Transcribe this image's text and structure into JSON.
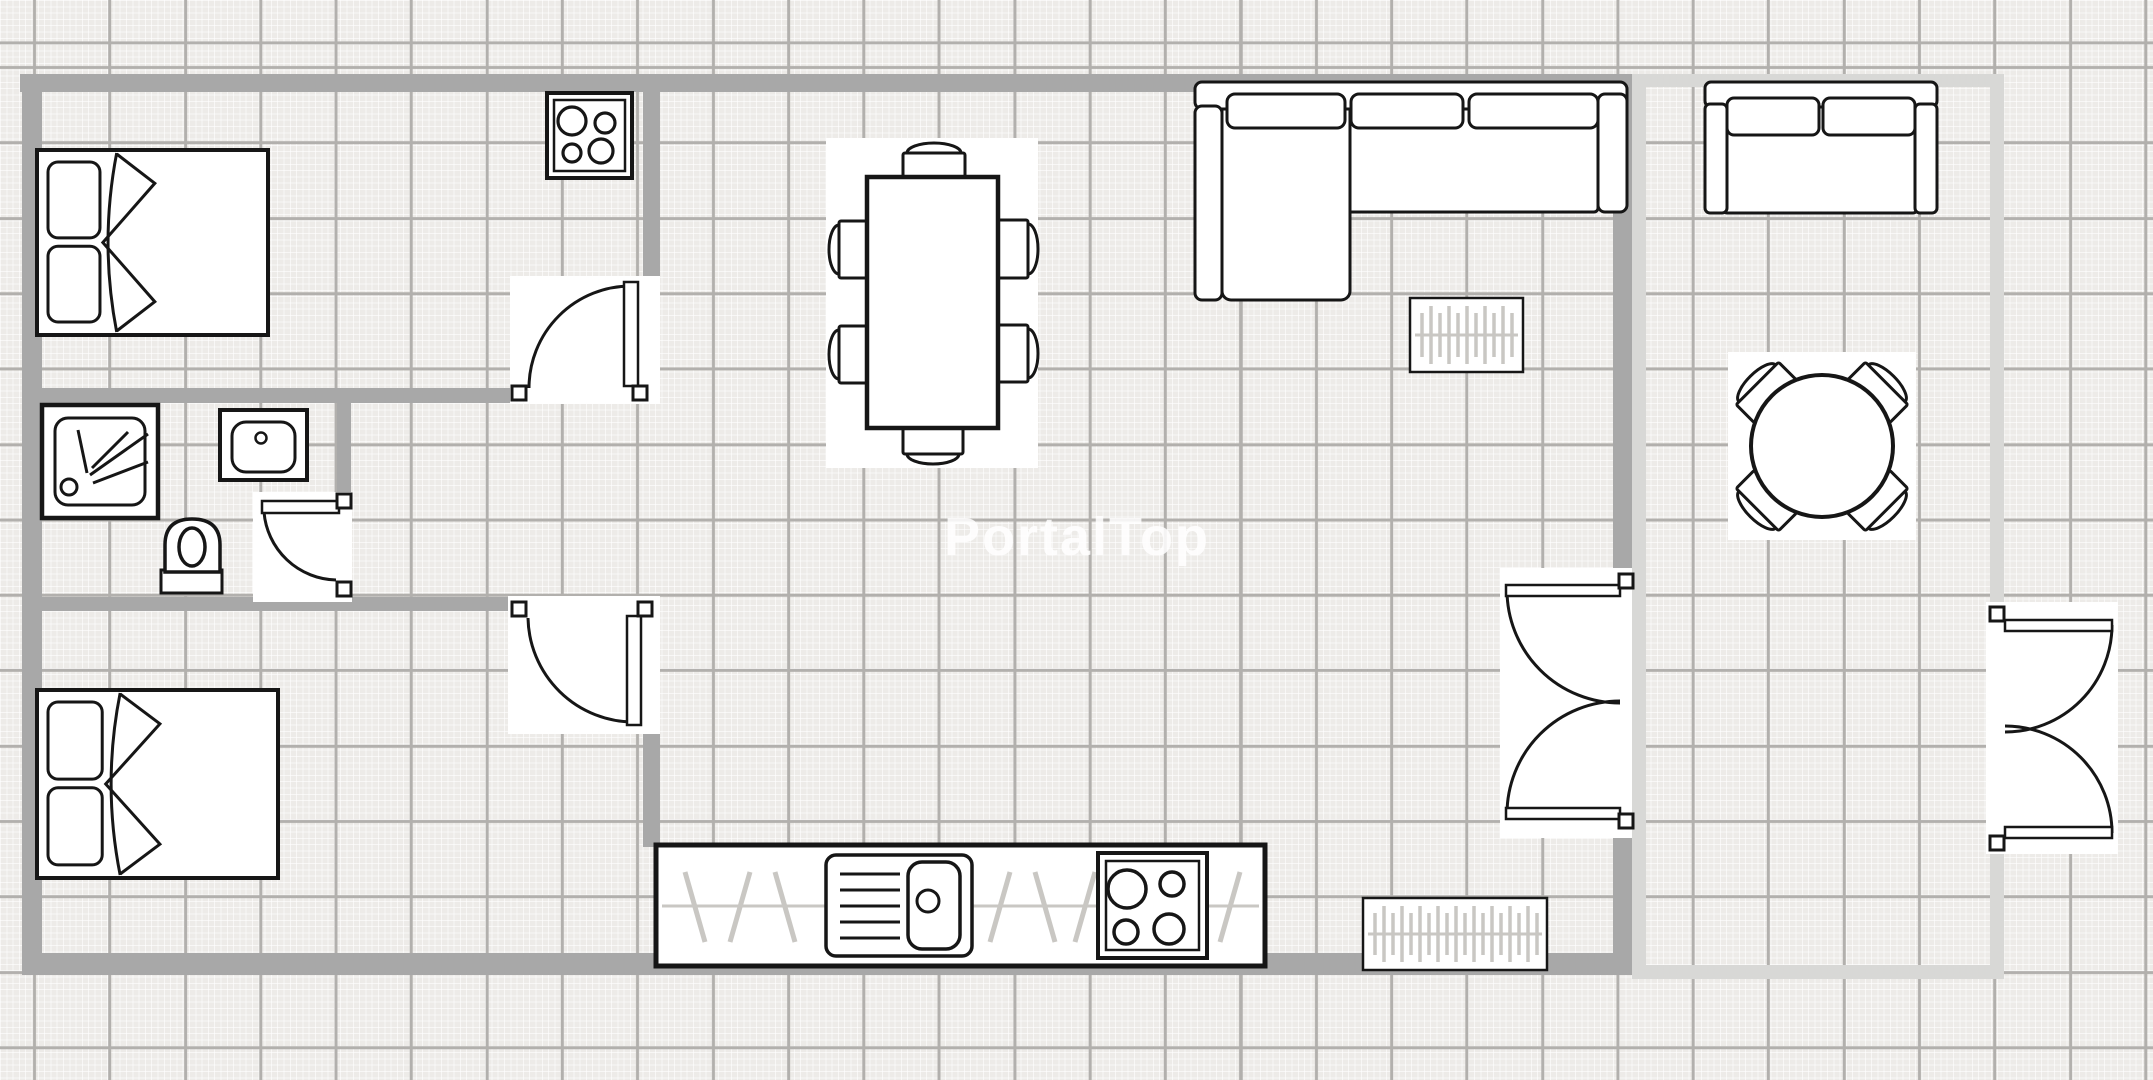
{
  "app": {
    "name": "floor-plan",
    "watermark_text": "PortalTop"
  },
  "canvas": {
    "w": 2153,
    "h": 1080,
    "bg": "#edebe8",
    "fine_line": "rgba(255,255,255,0.62)",
    "fine_step": 6.3,
    "major_line": "#b2b0ad",
    "major_step": 75.4,
    "major_off_x": 33,
    "major_off_y": 66,
    "wall_color": "#a8a8a8",
    "wall_light_color": "#d8d8d6",
    "ink": "#161616",
    "pattern_color": "#c9c7c3",
    "backdrop": "#ffffff"
  },
  "watermark": {
    "text": "PortalTop",
    "x": 1077,
    "y": 555,
    "font_size": 54,
    "color": "rgba(255,255,255,0.85)"
  },
  "walls": [
    {
      "name": "wall-outer-top",
      "rect": [
        20,
        74,
        1612,
        18
      ]
    },
    {
      "name": "wall-outer-left",
      "rect": [
        22,
        74,
        20,
        901
      ]
    },
    {
      "name": "wall-outer-bottom",
      "rect": [
        22,
        953,
        1610,
        22
      ]
    },
    {
      "name": "wall-bedroom1-south",
      "rect": [
        42,
        388,
        473,
        15
      ]
    },
    {
      "name": "wall-bedroom1-east",
      "rect": [
        643,
        74,
        17,
        330
      ]
    },
    {
      "name": "wall-bathroom-east",
      "rect": [
        337,
        395,
        14,
        103
      ]
    },
    {
      "name": "wall-bedroom2-north",
      "rect": [
        42,
        597,
        470,
        14
      ]
    },
    {
      "name": "wall-bedroom2-east",
      "rect": [
        643,
        611,
        17,
        236
      ]
    },
    {
      "name": "wall-living-divider-upper",
      "rect": [
        1613,
        74,
        19,
        502
      ]
    },
    {
      "name": "wall-living-divider-lower",
      "rect": [
        1613,
        830,
        19,
        145
      ]
    },
    {
      "name": "wall-terrace-top",
      "rect": [
        1632,
        74,
        372,
        13
      ],
      "light": true
    },
    {
      "name": "wall-terrace-west",
      "rect": [
        1632,
        87,
        14,
        878
      ],
      "light": true
    },
    {
      "name": "wall-terrace-east-upper",
      "rect": [
        1990,
        87,
        14,
        521
      ],
      "light": true
    },
    {
      "name": "wall-terrace-east-lower",
      "rect": [
        1990,
        852,
        14,
        113
      ],
      "light": true
    },
    {
      "name": "wall-terrace-bottom",
      "rect": [
        1632,
        965,
        372,
        14
      ],
      "light": true
    }
  ],
  "doors": [
    {
      "name": "door-bedroom1",
      "backdrop": [
        510,
        276,
        150,
        128
      ],
      "stops": [
        [
          512,
          386
        ],
        [
          633,
          386
        ]
      ],
      "leaf": [
        624,
        282,
        14,
        104
      ],
      "arc": "M 631 286 A 102 102 0 0 0 529 388"
    },
    {
      "name": "door-bathroom",
      "backdrop": [
        253,
        492,
        99,
        110
      ],
      "stops": [
        [
          337,
          494
        ],
        [
          337,
          582
        ]
      ],
      "leaf": [
        262,
        501,
        77,
        12
      ],
      "arc": "M 264 512 A 74 74 0 0 0 336 580"
    },
    {
      "name": "door-bedroom2",
      "backdrop": [
        508,
        596,
        152,
        138
      ],
      "stops": [
        [
          512,
          602
        ],
        [
          638,
          602
        ]
      ],
      "leaf": [
        627,
        616,
        14,
        109
      ],
      "arc": "M 528 618 A 106 106 0 0 0 634 722"
    },
    {
      "name": "door-living-terrace",
      "backdrop": [
        1500,
        568,
        132,
        270
      ],
      "stops": [
        [
          1619,
          574
        ],
        [
          1619,
          814
        ]
      ],
      "leaf": [
        1506,
        585,
        114,
        11
      ],
      "leaf2": [
        1506,
        808,
        114,
        11
      ],
      "arc": "M 1507 590 A 113 113 0 0 0 1620 703",
      "arc2": "M 1507 814 A 113 113 0 0 1 1620 701"
    },
    {
      "name": "door-terrace-exterior",
      "backdrop": [
        1986,
        602,
        132,
        252
      ],
      "stops": [
        [
          1990,
          607
        ],
        [
          1990,
          836
        ]
      ],
      "leaf": [
        2005,
        620,
        107,
        11
      ],
      "leaf2": [
        2005,
        827,
        107,
        11
      ],
      "arc": "M 2112 625 A 107 107 0 0 1 2005 732",
      "arc2": "M 2112 833 A 107 107 0 0 0 2005 726"
    }
  ],
  "furniture": [
    {
      "type": "bed",
      "name": "bed-double-bedroom1",
      "rect": [
        37,
        150,
        231,
        185
      ]
    },
    {
      "type": "stove",
      "name": "stove-hob-top",
      "rect": [
        547,
        93,
        85,
        85
      ]
    },
    {
      "type": "shower",
      "name": "shower-tray",
      "rect": [
        42,
        405,
        116,
        113
      ]
    },
    {
      "type": "sink",
      "name": "bathroom-sink",
      "rect": [
        220,
        410,
        87,
        70
      ]
    },
    {
      "type": "toilet",
      "name": "toilet",
      "rect": [
        160,
        517,
        63,
        77
      ]
    },
    {
      "type": "bed",
      "name": "bed-double-bedroom2",
      "rect": [
        37,
        690,
        241,
        188
      ]
    },
    {
      "type": "sofa-sectional",
      "name": "corner-sofa",
      "rect": [
        1195,
        82,
        432,
        218
      ]
    },
    {
      "type": "radiator",
      "name": "radiator-living",
      "rect": [
        1410,
        298,
        113,
        74
      ]
    },
    {
      "type": "dining-set",
      "name": "dining-table-six-chairs",
      "rect": [
        826,
        138,
        212,
        330
      ]
    },
    {
      "type": "counter",
      "name": "kitchen-counter",
      "rect": [
        656,
        845,
        609,
        121
      ]
    },
    {
      "type": "radiator",
      "name": "radiator-kitchen",
      "rect": [
        1363,
        898,
        184,
        72
      ]
    },
    {
      "type": "loveseat",
      "name": "terrace-loveseat",
      "rect": [
        1705,
        82,
        232,
        131
      ]
    },
    {
      "type": "round-table-set",
      "name": "terrace-round-table",
      "rect": [
        1728,
        352,
        188,
        188
      ]
    }
  ]
}
